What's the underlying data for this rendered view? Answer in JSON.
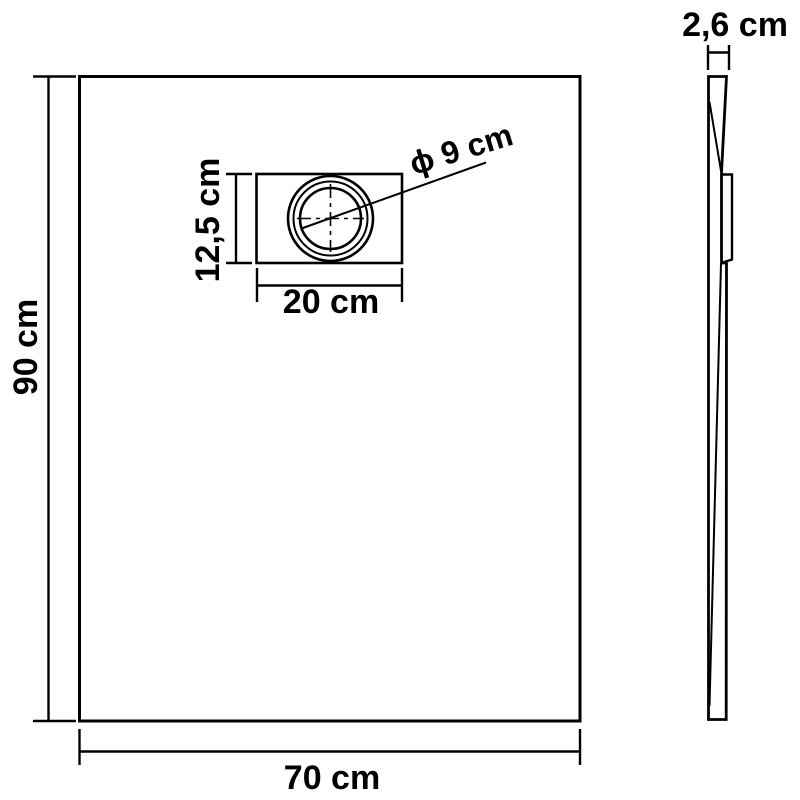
{
  "drawing": {
    "front_view": {
      "height_label": "90 cm",
      "width_label": "70 cm",
      "drain": {
        "width_label": "20 cm",
        "height_label": "12,5 cm",
        "diameter_label": "ϕ 9 cm"
      }
    },
    "side_view": {
      "thickness_label": "2,6 cm"
    }
  },
  "colors": {
    "line": "#000000",
    "text": "#000000",
    "background": "#ffffff"
  }
}
